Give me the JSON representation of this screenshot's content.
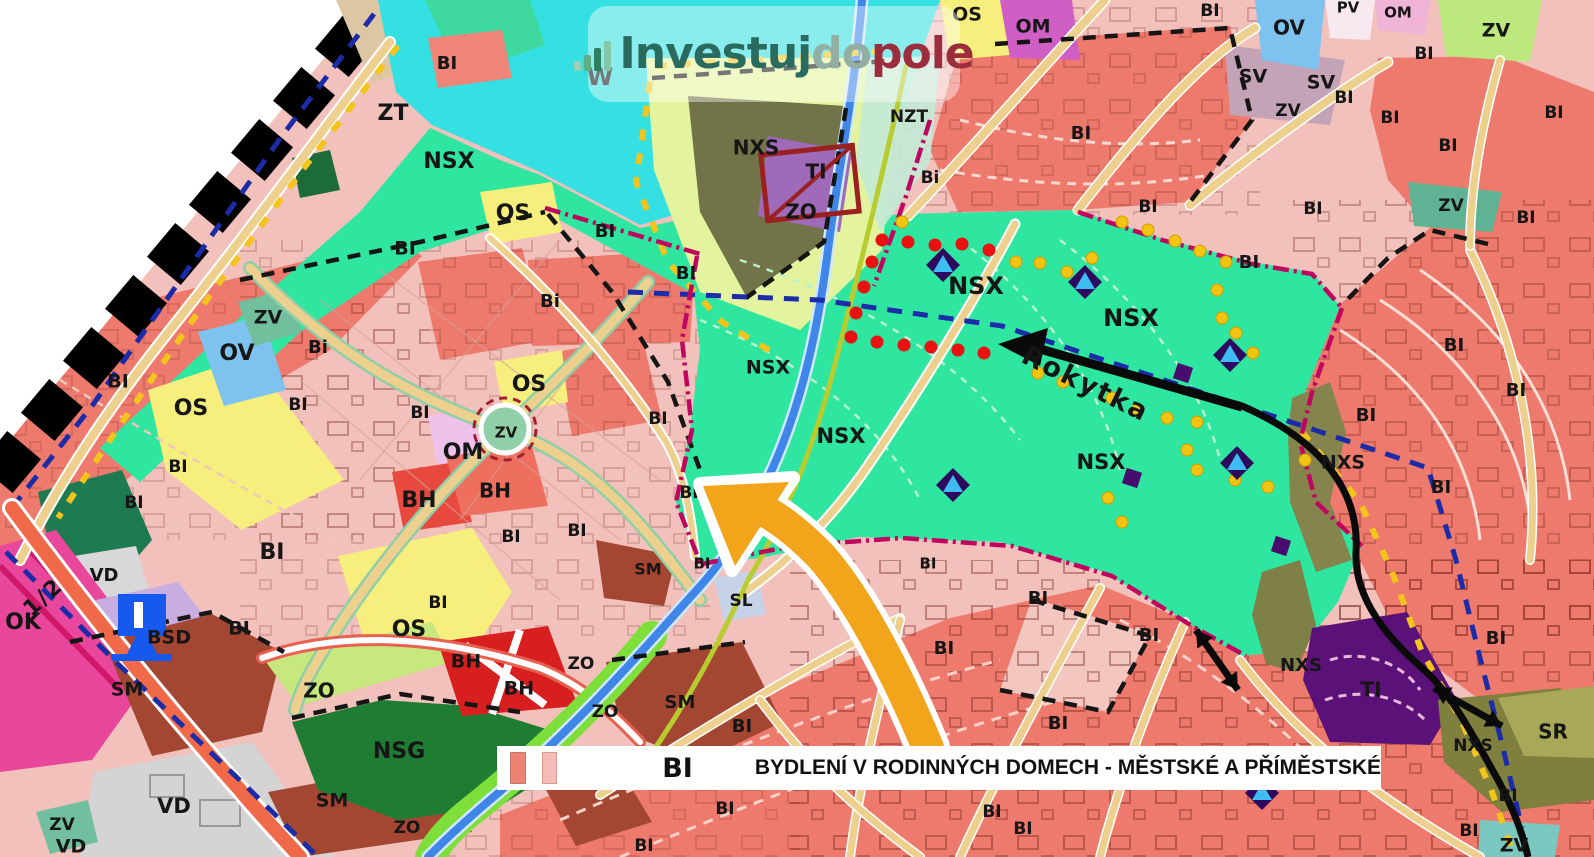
{
  "logo": {
    "icon": "bar-chart-icon",
    "part1": "Investuj",
    "part2": "do",
    "part3": "pole",
    "color1": "#2a6b5f",
    "color2": "#93afa4",
    "color3": "#9d2c3d"
  },
  "legend": {
    "code": "BI",
    "description": "BYDLENÍ V RODINNÝCH DOMECH - MĚSTSKÉ A PŘÍMĚSTSKÉ",
    "swatch1": "#ee8272",
    "swatch2": "#f4bcb6"
  },
  "annotations": {
    "stream": {
      "t": "Rokytka",
      "x": 1085,
      "y": 385,
      "r": 26,
      "s": 27
    },
    "fraction": {
      "t": "1/2",
      "x": 44,
      "y": 598,
      "r": -42,
      "s": 22
    }
  },
  "map_colors": {
    "bi_dark": "#ed7a6d",
    "bi_light": "#f3c1bc",
    "nsx_green": "#2ee6a0",
    "water": "#35e0e2",
    "os_yellow": "#f6ef7d",
    "ov_blue": "#7ec3ef",
    "ti_purple": "#5a1278",
    "nsg_green": "#1f7d33",
    "sm_brown": "#a34632",
    "ok_magenta": "#e8479b",
    "road_tan": "#edd08d"
  },
  "zone_labels": [
    {
      "t": "W",
      "x": 600,
      "y": 78,
      "s": 24
    },
    {
      "t": "BI",
      "x": 447,
      "y": 64,
      "s": 18
    },
    {
      "t": "ZT",
      "x": 393,
      "y": 114,
      "s": 22
    },
    {
      "t": "NSX",
      "x": 449,
      "y": 162,
      "s": 22
    },
    {
      "t": "OS",
      "x": 513,
      "y": 214,
      "s": 22
    },
    {
      "t": "BI",
      "x": 405,
      "y": 249,
      "s": 19
    },
    {
      "t": "BI",
      "x": 605,
      "y": 232,
      "s": 18
    },
    {
      "t": "Bi",
      "x": 550,
      "y": 302,
      "s": 18
    },
    {
      "t": "BI",
      "x": 686,
      "y": 274,
      "s": 18
    },
    {
      "t": "Bi",
      "x": 318,
      "y": 348,
      "s": 18
    },
    {
      "t": "ZV",
      "x": 268,
      "y": 318,
      "s": 19
    },
    {
      "t": "OV",
      "x": 237,
      "y": 354,
      "s": 22
    },
    {
      "t": "BI",
      "x": 118,
      "y": 382,
      "s": 19
    },
    {
      "t": "OS",
      "x": 191,
      "y": 409,
      "s": 22
    },
    {
      "t": "BI",
      "x": 298,
      "y": 405,
      "s": 17
    },
    {
      "t": "BI",
      "x": 420,
      "y": 413,
      "s": 17
    },
    {
      "t": "BI",
      "x": 178,
      "y": 467,
      "s": 17
    },
    {
      "t": "OS",
      "x": 529,
      "y": 385,
      "s": 22
    },
    {
      "t": "ZV",
      "x": 506,
      "y": 433,
      "s": 15
    },
    {
      "t": "OM",
      "x": 463,
      "y": 453,
      "s": 22
    },
    {
      "t": "BH",
      "x": 419,
      "y": 501,
      "s": 22
    },
    {
      "t": "BH",
      "x": 495,
      "y": 492,
      "s": 20
    },
    {
      "t": "BI",
      "x": 134,
      "y": 503,
      "s": 17
    },
    {
      "t": "BI",
      "x": 272,
      "y": 553,
      "s": 22
    },
    {
      "t": "BI",
      "x": 511,
      "y": 537,
      "s": 17
    },
    {
      "t": "BI",
      "x": 577,
      "y": 531,
      "s": 17
    },
    {
      "t": "BI",
      "x": 658,
      "y": 419,
      "s": 17
    },
    {
      "t": "VD",
      "x": 104,
      "y": 576,
      "s": 18
    },
    {
      "t": "OK",
      "x": 23,
      "y": 623,
      "s": 22
    },
    {
      "t": "BSD",
      "x": 169,
      "y": 638,
      "s": 19
    },
    {
      "t": "BI",
      "x": 239,
      "y": 629,
      "s": 19
    },
    {
      "t": "BI",
      "x": 438,
      "y": 603,
      "s": 17
    },
    {
      "t": "OS",
      "x": 409,
      "y": 630,
      "s": 22
    },
    {
      "t": "BH",
      "x": 466,
      "y": 662,
      "s": 19
    },
    {
      "t": "BH",
      "x": 519,
      "y": 689,
      "s": 19
    },
    {
      "t": "ZO",
      "x": 319,
      "y": 692,
      "s": 20
    },
    {
      "t": "SM",
      "x": 127,
      "y": 690,
      "s": 19
    },
    {
      "t": "ZO",
      "x": 581,
      "y": 664,
      "s": 17
    },
    {
      "t": "ZO",
      "x": 605,
      "y": 712,
      "s": 17
    },
    {
      "t": "SM",
      "x": 648,
      "y": 570,
      "s": 16
    },
    {
      "t": "NSG",
      "x": 399,
      "y": 752,
      "s": 22
    },
    {
      "t": "SM",
      "x": 332,
      "y": 801,
      "s": 19
    },
    {
      "t": "ZO",
      "x": 407,
      "y": 828,
      "s": 17
    },
    {
      "t": "VD",
      "x": 174,
      "y": 807,
      "s": 21
    },
    {
      "t": "VD",
      "x": 71,
      "y": 847,
      "s": 19
    },
    {
      "t": "ZV",
      "x": 62,
      "y": 825,
      "s": 17
    },
    {
      "t": "SL",
      "x": 741,
      "y": 601,
      "s": 17
    },
    {
      "t": "BI",
      "x": 689,
      "y": 493,
      "s": 17
    },
    {
      "t": "BI",
      "x": 702,
      "y": 564,
      "s": 15
    },
    {
      "t": "SM",
      "x": 680,
      "y": 703,
      "s": 18
    },
    {
      "t": "BI",
      "x": 742,
      "y": 727,
      "s": 18
    },
    {
      "t": "BI",
      "x": 725,
      "y": 809,
      "s": 17
    },
    {
      "t": "BI",
      "x": 644,
      "y": 846,
      "s": 17
    },
    {
      "t": "BI",
      "x": 1023,
      "y": 829,
      "s": 17
    },
    {
      "t": "NXS",
      "x": 756,
      "y": 149,
      "s": 20
    },
    {
      "t": "TI",
      "x": 816,
      "y": 173,
      "s": 20
    },
    {
      "t": "ZO",
      "x": 801,
      "y": 213,
      "s": 20
    },
    {
      "t": "NZT",
      "x": 909,
      "y": 117,
      "s": 17
    },
    {
      "t": "Bi",
      "x": 930,
      "y": 178,
      "s": 17
    },
    {
      "t": "OS",
      "x": 967,
      "y": 15,
      "s": 19
    },
    {
      "t": "OM",
      "x": 1033,
      "y": 27,
      "s": 19
    },
    {
      "t": "BI",
      "x": 1210,
      "y": 11,
      "s": 17
    },
    {
      "t": "BI",
      "x": 1081,
      "y": 134,
      "s": 18
    },
    {
      "t": "OV",
      "x": 1289,
      "y": 29,
      "s": 20
    },
    {
      "t": "SV",
      "x": 1253,
      "y": 77,
      "s": 19
    },
    {
      "t": "SV",
      "x": 1321,
      "y": 83,
      "s": 19
    },
    {
      "t": "ZV",
      "x": 1288,
      "y": 111,
      "s": 17
    },
    {
      "t": "BI",
      "x": 1344,
      "y": 98,
      "s": 17
    },
    {
      "t": "PV",
      "x": 1348,
      "y": 8,
      "s": 15
    },
    {
      "t": "OM",
      "x": 1398,
      "y": 13,
      "s": 15
    },
    {
      "t": "ZV",
      "x": 1496,
      "y": 31,
      "s": 19
    },
    {
      "t": "BI",
      "x": 1424,
      "y": 54,
      "s": 17
    },
    {
      "t": "BI",
      "x": 1390,
      "y": 118,
      "s": 17
    },
    {
      "t": "BI",
      "x": 1448,
      "y": 146,
      "s": 17
    },
    {
      "t": "ZV",
      "x": 1451,
      "y": 206,
      "s": 17
    },
    {
      "t": "BI",
      "x": 1313,
      "y": 209,
      "s": 17
    },
    {
      "t": "BI",
      "x": 1526,
      "y": 218,
      "s": 17
    },
    {
      "t": "BI",
      "x": 1554,
      "y": 113,
      "s": 17
    },
    {
      "t": "NSX",
      "x": 976,
      "y": 287,
      "s": 24
    },
    {
      "t": "NSX",
      "x": 1131,
      "y": 319,
      "s": 24
    },
    {
      "t": "NSX",
      "x": 841,
      "y": 437,
      "s": 21
    },
    {
      "t": "NSX",
      "x": 1101,
      "y": 463,
      "s": 21
    },
    {
      "t": "NSX",
      "x": 768,
      "y": 368,
      "s": 19
    },
    {
      "t": "BI",
      "x": 1148,
      "y": 207,
      "s": 17
    },
    {
      "t": "BI",
      "x": 1249,
      "y": 263,
      "s": 18
    },
    {
      "t": "NXS",
      "x": 1343,
      "y": 463,
      "s": 19
    },
    {
      "t": "BI",
      "x": 1454,
      "y": 346,
      "s": 18
    },
    {
      "t": "BI",
      "x": 1516,
      "y": 391,
      "s": 18
    },
    {
      "t": "BI",
      "x": 1366,
      "y": 416,
      "s": 18
    },
    {
      "t": "BI",
      "x": 1441,
      "y": 488,
      "s": 18
    },
    {
      "t": "BI",
      "x": 1496,
      "y": 639,
      "s": 18
    },
    {
      "t": "NXS",
      "x": 1301,
      "y": 666,
      "s": 18
    },
    {
      "t": "TI",
      "x": 1371,
      "y": 691,
      "s": 20
    },
    {
      "t": "SR",
      "x": 1553,
      "y": 733,
      "s": 20
    },
    {
      "t": "NXS",
      "x": 1473,
      "y": 746,
      "s": 17
    },
    {
      "t": "ZV",
      "x": 1514,
      "y": 846,
      "s": 19
    },
    {
      "t": "BI",
      "x": 1508,
      "y": 796,
      "s": 17
    },
    {
      "t": "BI",
      "x": 1469,
      "y": 831,
      "s": 17
    },
    {
      "t": "BI",
      "x": 1038,
      "y": 599,
      "s": 18
    },
    {
      "t": "BI",
      "x": 944,
      "y": 649,
      "s": 18
    },
    {
      "t": "BI",
      "x": 1149,
      "y": 636,
      "s": 18
    },
    {
      "t": "BI",
      "x": 1058,
      "y": 724,
      "s": 18
    },
    {
      "t": "BI",
      "x": 928,
      "y": 564,
      "s": 15
    },
    {
      "t": "BI",
      "x": 992,
      "y": 812,
      "s": 17
    }
  ],
  "markers": {
    "red_dots": [
      [
        882,
        240
      ],
      [
        908,
        242
      ],
      [
        935,
        245
      ],
      [
        962,
        244
      ],
      [
        989,
        250
      ],
      [
        872,
        262
      ],
      [
        864,
        287
      ],
      [
        856,
        313
      ],
      [
        851,
        337
      ],
      [
        877,
        342
      ],
      [
        904,
        345
      ],
      [
        931,
        347
      ],
      [
        958,
        350
      ],
      [
        984,
        353
      ]
    ],
    "yellow_dots": [
      [
        902,
        222
      ],
      [
        1122,
        222
      ],
      [
        1148,
        230
      ],
      [
        1175,
        241
      ],
      [
        1200,
        251
      ],
      [
        1226,
        262
      ],
      [
        1092,
        258
      ],
      [
        1067,
        272
      ],
      [
        1040,
        263
      ],
      [
        1016,
        262
      ],
      [
        1217,
        290
      ],
      [
        1222,
        318
      ],
      [
        1236,
        333
      ],
      [
        1253,
        353
      ],
      [
        1038,
        373
      ],
      [
        1063,
        382
      ],
      [
        1112,
        398
      ],
      [
        1137,
        410
      ],
      [
        1167,
        418
      ],
      [
        1197,
        422
      ],
      [
        1187,
        450
      ],
      [
        1197,
        470
      ],
      [
        1235,
        480
      ],
      [
        1268,
        487
      ],
      [
        1305,
        460
      ],
      [
        1108,
        498
      ],
      [
        1122,
        522
      ]
    ],
    "blue_triangle_markers": [
      [
        943,
        265
      ],
      [
        1085,
        282
      ],
      [
        1230,
        355
      ],
      [
        1237,
        463
      ],
      [
        953,
        485
      ],
      [
        1262,
        793
      ]
    ],
    "purple_squares": [
      [
        1183,
        373
      ],
      [
        1132,
        478
      ],
      [
        1281,
        546
      ]
    ],
    "double_arrows": [
      [
        1196,
        630,
        1238,
        690
      ],
      [
        1434,
        688,
        1502,
        726
      ]
    ]
  }
}
